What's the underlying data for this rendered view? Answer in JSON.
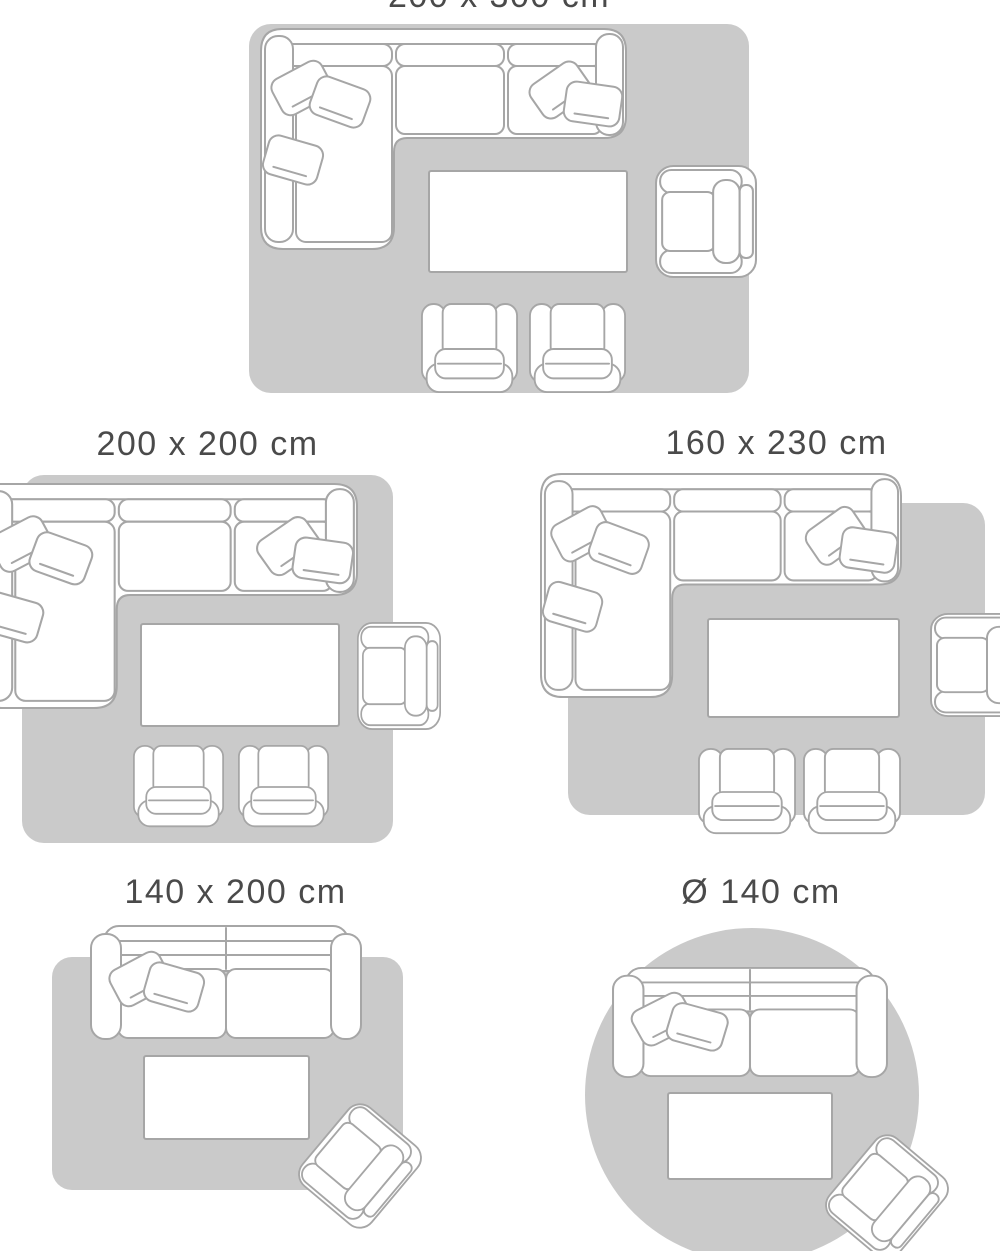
{
  "colors": {
    "bg": "#ffffff",
    "rug": "#cacaca",
    "fill": "#ffffff",
    "outline": "#a6a6a6",
    "text": "#4a4a4a"
  },
  "diagrams": [
    {
      "label": "200 x 300 cm",
      "shape": "rectangular-rug",
      "label_cropped_at_top": true,
      "furniture": [
        "sectional-sofa",
        "coffee-table",
        "armchair",
        "accent-chair",
        "accent-chair"
      ]
    },
    {
      "label": "200 x 200 cm",
      "shape": "rectangular-rug",
      "furniture": [
        "sectional-sofa",
        "coffee-table",
        "armchair",
        "accent-chair",
        "accent-chair"
      ]
    },
    {
      "label": "160 x 230 cm",
      "shape": "rectangular-rug",
      "furniture": [
        "sectional-sofa",
        "coffee-table",
        "armchair",
        "accent-chair",
        "accent-chair"
      ]
    },
    {
      "label": "140 x 200 cm",
      "shape": "rectangular-rug",
      "furniture": [
        "loveseat-sofa",
        "coffee-table",
        "armchair-rotated"
      ]
    },
    {
      "label": "Ø 140 cm",
      "shape": "round-rug",
      "furniture": [
        "loveseat-sofa",
        "coffee-table",
        "armchair-rotated"
      ]
    }
  ]
}
